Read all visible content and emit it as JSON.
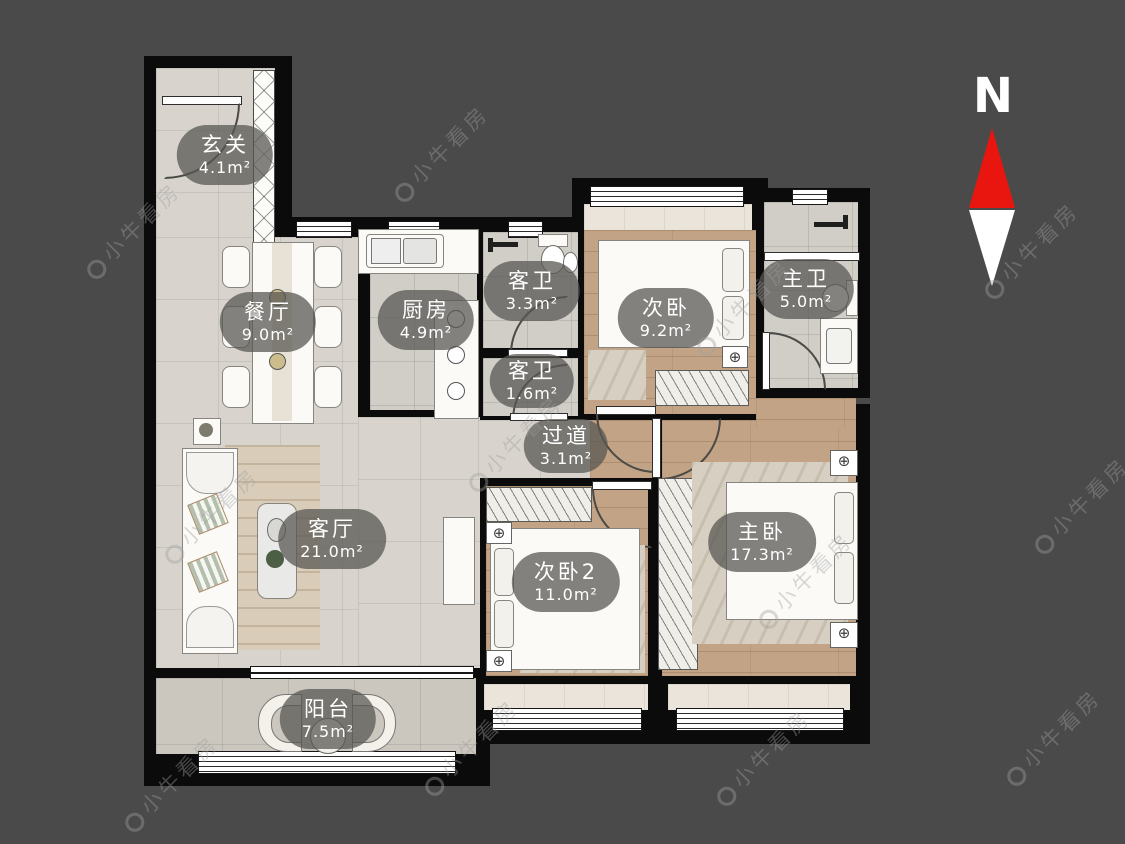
{
  "background": "#4a4a4a",
  "compass": {
    "label": "N",
    "north_color": "#e8160f",
    "south_color": "#ffffff"
  },
  "watermark": {
    "text": "小牛看房",
    "icon": "niu-logo-icon"
  },
  "rooms": [
    {
      "name": "玄关",
      "area": "4.1m²"
    },
    {
      "name": "餐厅",
      "area": "9.0m²"
    },
    {
      "name": "厨房",
      "area": "4.9m²"
    },
    {
      "name": "客卫",
      "area": "3.3m²"
    },
    {
      "name": "客卫",
      "area": "1.6m²"
    },
    {
      "name": "次卧",
      "area": "9.2m²"
    },
    {
      "name": "主卫",
      "area": "5.0m²"
    },
    {
      "name": "过道",
      "area": "3.1m²"
    },
    {
      "name": "客厅",
      "area": "21.0m²"
    },
    {
      "name": "次卧2",
      "area": "11.0m²"
    },
    {
      "name": "主卧",
      "area": "17.3m²"
    },
    {
      "name": "阳台",
      "area": "7.5m²"
    }
  ]
}
